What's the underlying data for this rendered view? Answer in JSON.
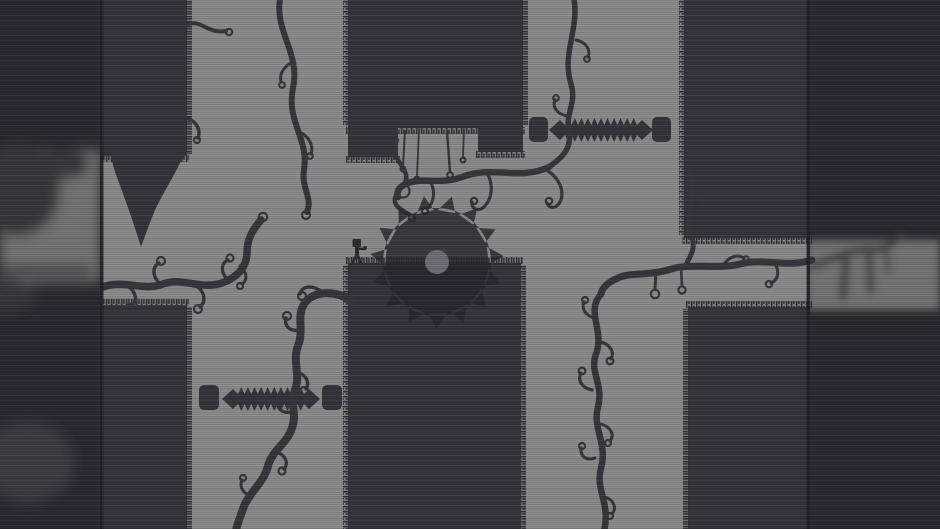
{
  "meta": {
    "app": "monochrome-puzzle-platformer",
    "view": "level-screenshot",
    "description": "Cross-shaped corridor level with dark pillars, curling vines, one circular saw blade, two horizontal spike traps and a small armed character; blurred depth-of-field strips on left and right edges."
  },
  "palette": {
    "bg_base": "#8c8c8c",
    "pillar": "#35353a",
    "grass": "#2e2e33",
    "vine": "#37373b",
    "saw": "#28282c",
    "saw_opacity": "0.82",
    "saw_hub": "#707074",
    "spike": "#36363a",
    "character": "#2c2c30",
    "strip_base": "#2b2b2f",
    "strip_band": "#757575",
    "strip_blob": "#37373b",
    "strip_faint": "#4e4e53",
    "divider": "#1f1f23"
  },
  "scene": {
    "viewport": {
      "width": 940,
      "height": 529
    },
    "saw": {
      "cx": 437,
      "cy": 262,
      "disc_r": 54,
      "tooth_r": 67,
      "teeth": 15,
      "hub_r": 12
    },
    "character": {
      "x": 357,
      "y": 251,
      "facing": "right",
      "holding": "gun"
    },
    "spike_traps": [
      {
        "id": "top-right",
        "blocks": [
          {
            "x": 529,
            "y": 117,
            "w": 19,
            "h": 25
          },
          {
            "x": 652,
            "y": 117,
            "w": 19,
            "h": 25
          }
        ],
        "bar": {
          "x1": 549,
          "x2": 653,
          "cy": 130,
          "teeth": 11,
          "amp": 12
        }
      },
      {
        "id": "bottom-left",
        "blocks": [
          {
            "x": 199,
            "y": 385,
            "w": 20,
            "h": 25
          },
          {
            "x": 322,
            "y": 385,
            "w": 20,
            "h": 25
          }
        ],
        "bar": {
          "x1": 222,
          "x2": 320,
          "cy": 399,
          "teeth": 10,
          "amp": 12
        }
      }
    ],
    "pillars": [
      {
        "id": "top-left",
        "x": 103,
        "y": -4,
        "w": 84,
        "h": 160,
        "grass": [
          "bottom"
        ],
        "fringe": [
          "right"
        ]
      },
      {
        "id": "top-middle",
        "x": 348,
        "y": -4,
        "w": 175,
        "h": 132,
        "grass": [
          "bottom"
        ],
        "fringe": [
          "left",
          "right"
        ]
      },
      {
        "id": "top-middle-foot-l",
        "x": 348,
        "y": 120,
        "w": 50,
        "h": 37,
        "grass": [
          "bottom"
        ],
        "fringe": []
      },
      {
        "id": "top-middle-foot-r",
        "x": 478,
        "y": 120,
        "w": 45,
        "h": 32,
        "grass": [
          "bottom"
        ],
        "fringe": []
      },
      {
        "id": "top-right",
        "x": 684,
        "y": -4,
        "w": 126,
        "h": 242,
        "grass": [
          "bottom"
        ],
        "fringe": [
          "left"
        ]
      },
      {
        "id": "bottom-left",
        "x": 103,
        "y": 305,
        "w": 84,
        "h": 228,
        "grass": [
          "top"
        ],
        "fringe": [
          "right"
        ]
      },
      {
        "id": "bottom-middle",
        "x": 348,
        "y": 263,
        "w": 173,
        "h": 270,
        "grass": [
          "top"
        ],
        "fringe": [
          "left",
          "right"
        ]
      },
      {
        "id": "bottom-right",
        "x": 688,
        "y": 307,
        "w": 122,
        "h": 226,
        "grass": [
          "top"
        ],
        "fringe": [
          "left"
        ]
      }
    ],
    "vines": [
      {
        "id": "top-left-gap",
        "from": [
          281,
          0
        ],
        "to": [
          307,
          212
        ]
      },
      {
        "id": "top-left-pillar-stub",
        "from": [
          188,
          24
        ],
        "to": [
          229,
          32
        ]
      },
      {
        "id": "top-right-gap",
        "from": [
          573,
          0
        ],
        "to": [
          549,
          167
        ]
      },
      {
        "id": "mid-horizontal",
        "from": [
          549,
          167
        ],
        "to": [
          398,
          197
        ]
      },
      {
        "id": "notch-strings",
        "from": [
          405,
          131
        ],
        "to": [
          463,
          160
        ]
      },
      {
        "id": "notch-loop",
        "from": [
          397,
          140
        ],
        "to": [
          410,
          215
        ]
      },
      {
        "id": "right-gap-vertical",
        "from": [
          689,
          167
        ],
        "to": [
          687,
          263
        ]
      },
      {
        "id": "right-corridor",
        "from": [
          812,
          260
        ],
        "to": [
          601,
          294
        ]
      },
      {
        "id": "bottom-right-vertical",
        "from": [
          601,
          294
        ],
        "to": [
          604,
          529
        ]
      },
      {
        "id": "bottom-left-diagonal",
        "from": [
          352,
          301
        ],
        "to": [
          236,
          529
        ]
      },
      {
        "id": "left-corridor",
        "from": [
          100,
          288
        ],
        "to": [
          261,
          220
        ]
      }
    ],
    "depth_blur": {
      "left_strip": {
        "x": 0,
        "w": 101,
        "band_y": 150,
        "band_h": 132
      },
      "right_strip": {
        "x": 806,
        "w": 134,
        "band_y": 240,
        "band_h": 70
      }
    }
  }
}
